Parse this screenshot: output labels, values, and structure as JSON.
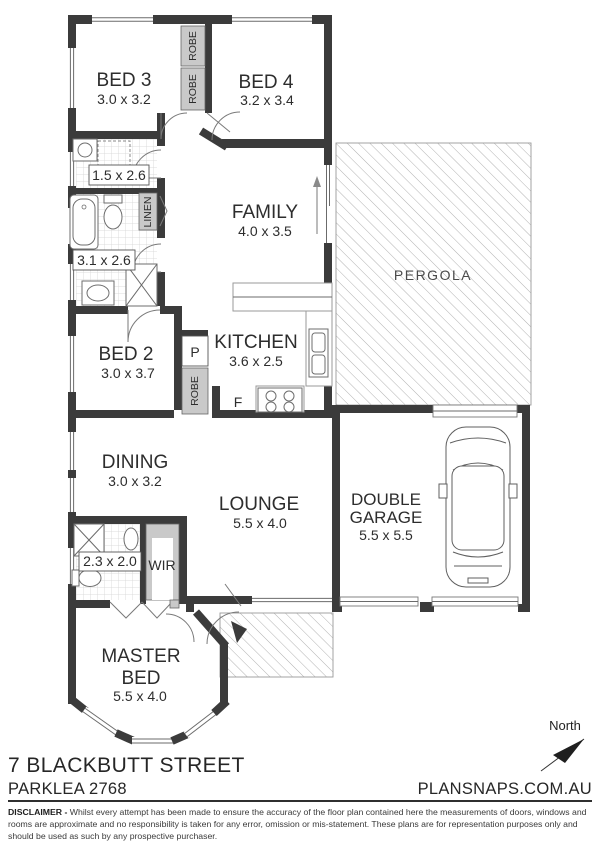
{
  "colors": {
    "wall": "#3b3b3b",
    "robe_fill": "#c9c9c9",
    "hatch_line": "#b2b2b2",
    "tile_line": "#d4d4d4",
    "text": "#2d2d2d"
  },
  "rooms": {
    "bed3": {
      "name": "BED 3",
      "dims": "3.0 x 3.2"
    },
    "bed4": {
      "name": "BED 4",
      "dims": "3.2 x 3.4"
    },
    "laundry": {
      "dims": "1.5 x 2.6"
    },
    "bathroom": {
      "dims": "3.1 x 2.6"
    },
    "family": {
      "name": "FAMILY",
      "dims": "4.0 x 3.5"
    },
    "kitchen": {
      "name": "KITCHEN",
      "dims": "3.6 x 2.5"
    },
    "bed2": {
      "name": "BED 2",
      "dims": "3.0 x 3.7"
    },
    "dining": {
      "name": "DINING",
      "dims": "3.0 x 3.2"
    },
    "lounge": {
      "name": "LOUNGE",
      "dims": "5.5 x 4.0"
    },
    "ensuite": {
      "dims": "2.3 x 2.0"
    },
    "wir": {
      "name": "WIR"
    },
    "master": {
      "line1": "MASTER",
      "line2": "BED",
      "dims": "5.5 x 4.0"
    },
    "pergola": {
      "name": "PERGOLA"
    },
    "garage": {
      "line1": "DOUBLE",
      "line2": "GARAGE",
      "dims": "5.5 x 5.5"
    }
  },
  "closets": {
    "robe_top": "ROBE",
    "robe_bottom": "ROBE",
    "robe_bed2": "ROBE",
    "linen": "LINEN",
    "pantry": "P",
    "fridge": "F"
  },
  "compass": {
    "label": "North"
  },
  "footer": {
    "address_line1": "7 BLACKBUTT STREET",
    "address_line2": "PARKLEA 2768",
    "brand": "PLANSNAPS.COM.AU",
    "disclaimer_label": "DISCLAIMER -",
    "disclaimer_text": " Whilst every attempt has been made to ensure the accuracy of the floor plan contained here the measurements of doors, windows and rooms are approximate and no responsibility is taken for any error, omission or mis-statement. These plans are for representation purposes only and should be used as such by any prospective purchaser."
  }
}
